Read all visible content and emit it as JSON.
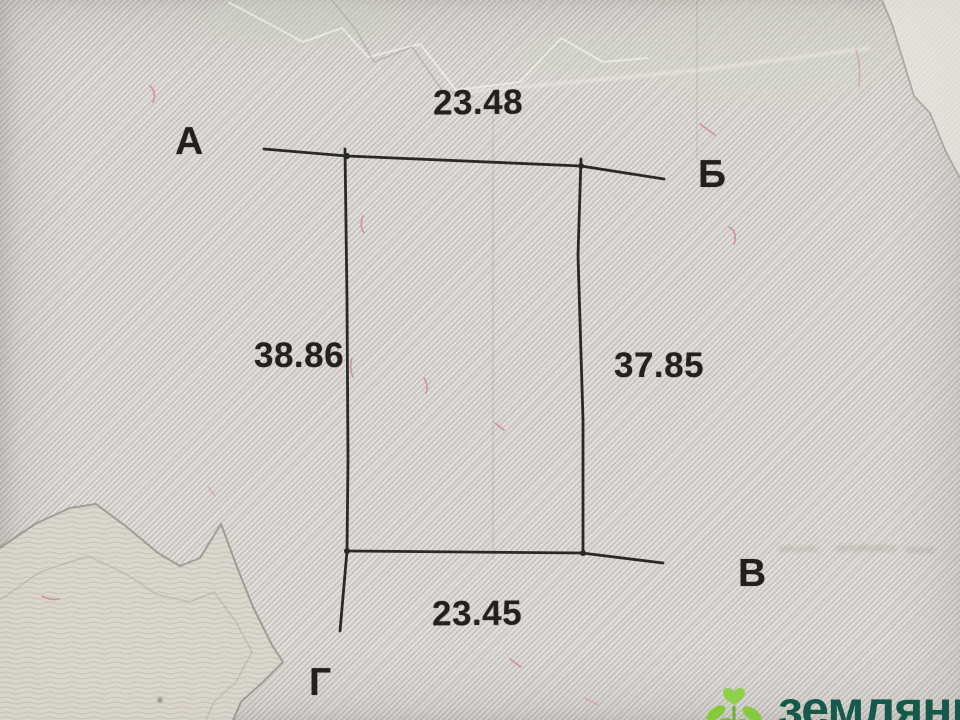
{
  "parcel": {
    "corners": [
      {
        "id": "a",
        "label": "А",
        "position": "top-left"
      },
      {
        "id": "b",
        "label": "Б",
        "position": "top-right"
      },
      {
        "id": "v",
        "label": "В",
        "position": "bottom-right"
      },
      {
        "id": "g",
        "label": "Г",
        "position": "bottom-left"
      }
    ],
    "sides": [
      {
        "edge": "А-Б",
        "position": "top",
        "length": "23.48"
      },
      {
        "edge": "А-Г",
        "position": "left",
        "length": "38.86"
      },
      {
        "edge": "Б-В",
        "position": "right",
        "length": "37.85"
      },
      {
        "edge": "Г-В",
        "position": "bottom",
        "length": "23.45"
      }
    ]
  },
  "watermark": {
    "text": "земляни",
    "icon": "sprout-icon",
    "icon_color": "#8bc83e",
    "text_color": "#14594a"
  },
  "colors": {
    "paper": "#d5d1cc",
    "stripe_light": "#e4e0db",
    "stripe_dark": "#c9c5c0",
    "ink": "#1c1c1c",
    "fiber_pink": "#d4849a",
    "zigzag_gray": "#8e8a84"
  }
}
